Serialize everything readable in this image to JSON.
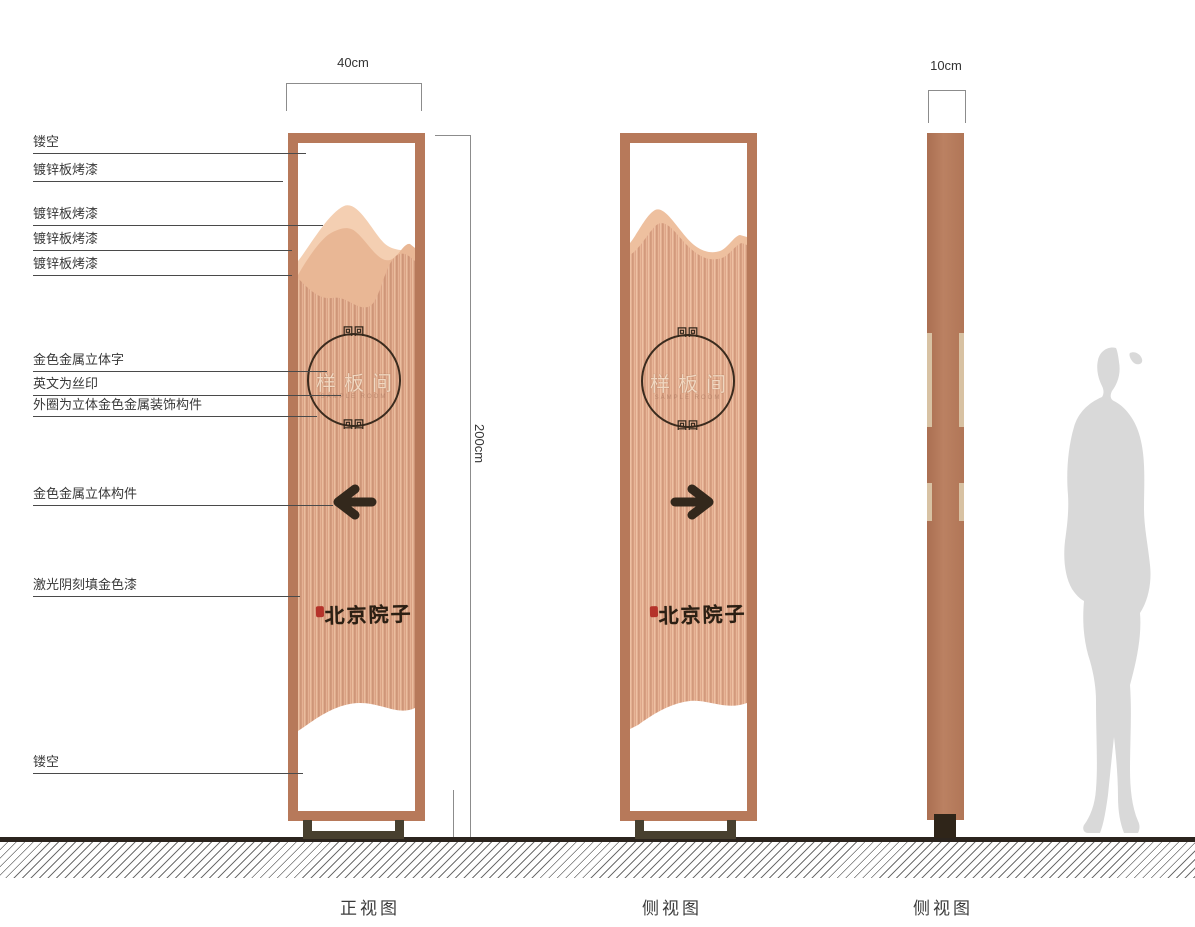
{
  "dimensions": {
    "front_width": "40cm",
    "total_height": "200cm",
    "side_depth": "10cm"
  },
  "callouts": [
    {
      "label": "镂空"
    },
    {
      "label": "镀锌板烤漆"
    },
    {
      "label": "镀锌板烤漆"
    },
    {
      "label": "镀锌板烤漆"
    },
    {
      "label": "镀锌板烤漆"
    },
    {
      "label": "金色金属立体字"
    },
    {
      "label": "英文为丝印"
    },
    {
      "label": "外圈为立体金色金属装饰构件"
    },
    {
      "label": "金色金属立体构件"
    },
    {
      "label": "激光阴刻填金色漆"
    },
    {
      "label": "镂空"
    }
  ],
  "views": [
    {
      "label": "正视图"
    },
    {
      "label": "侧视图"
    },
    {
      "label": "侧视图"
    }
  ],
  "sign": {
    "circle_text": "样板间",
    "english_subtext": "SAMPLE ROOM",
    "brand_text": "北京院子",
    "ornament_glyph": "回回"
  },
  "colors": {
    "frame_copper": "#b7795a",
    "panel_copper": "#dca183",
    "mountain_back": "#f4cfb2",
    "mountain_front": "#e9b795",
    "dark_metal": "#33281c",
    "base_dark": "#48402f",
    "seal_red": "#b5332a",
    "silhouette_gray": "#d9d9d9",
    "ground_dark": "#2b241e"
  }
}
